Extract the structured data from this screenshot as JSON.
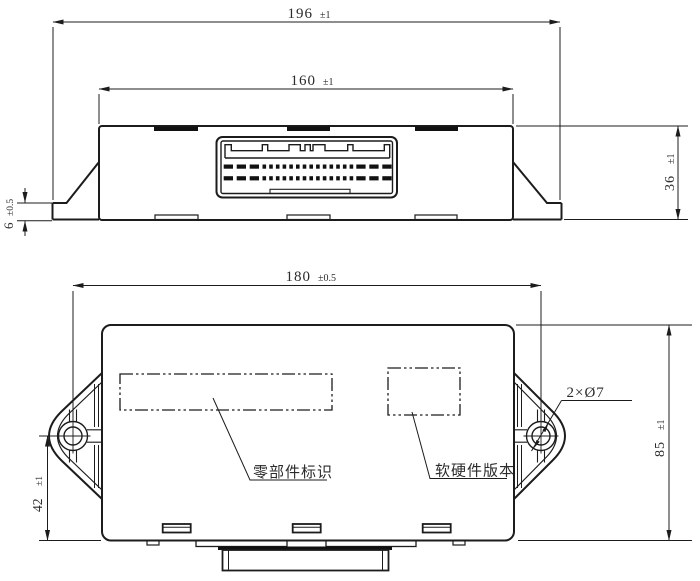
{
  "drawing": {
    "dims": {
      "overall_width": {
        "value": "196",
        "tol": "±1"
      },
      "body_width": {
        "value": "160",
        "tol": "±1"
      },
      "side_height": {
        "value": "36",
        "tol": "±1"
      },
      "flange_thickness": {
        "value": "6",
        "tol": "±0.5"
      },
      "hole_spacing": {
        "value": "180",
        "tol": "±0.5"
      },
      "front_height": {
        "value": "85",
        "tol": "±1"
      },
      "hole_to_bottom": {
        "value": "42",
        "tol": "±1"
      },
      "mounting_holes": {
        "value": "2×Ø7"
      }
    },
    "labels": {
      "part_marking": "零部件标识",
      "version_marking": "软硬件版本"
    },
    "colors": {
      "line": "#1c1c1c",
      "text": "#2b2b2b",
      "background": "#ffffff"
    }
  }
}
